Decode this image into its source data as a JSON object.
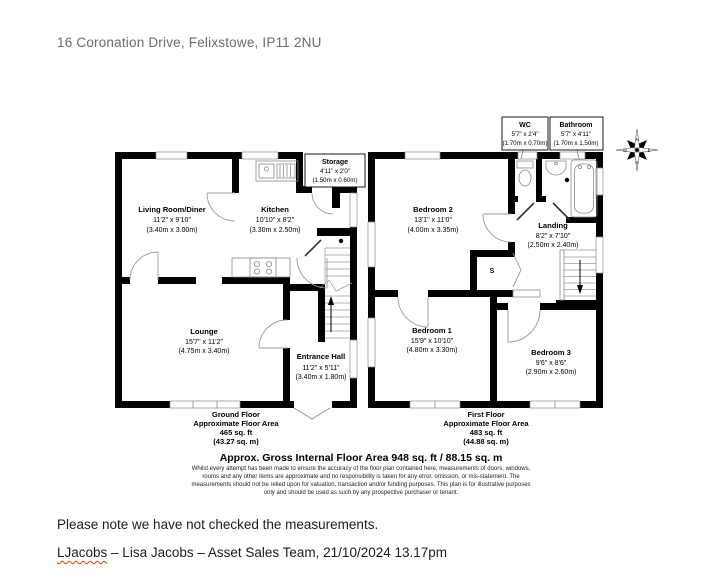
{
  "document": {
    "address": "16 Coronation Drive, Felixstowe, IP11 2NU",
    "note": "Please note we have not checked the measurements.",
    "signature_user": "LJacobs",
    "signature_rest": " – Lisa Jacobs – Asset Sales Team, 21/10/2024 13.17pm"
  },
  "floorplan": {
    "ground": {
      "rooms": [
        {
          "name": "Living Room/Diner",
          "imperial": "11'2\" x 9'10\"",
          "metric": "(3.40m x 3.00m)"
        },
        {
          "name": "Kitchen",
          "imperial": "10'10\" x 8'2\"",
          "metric": "(3.30m x 2.50m)"
        },
        {
          "name": "Storage",
          "imperial": "4'11\" x 2'0\"",
          "metric": "(1.50m x 0.60m)"
        },
        {
          "name": "Lounge",
          "imperial": "15'7\" x 11'2\"",
          "metric": "(4.75m x 3.40m)"
        },
        {
          "name": "Entrance Hall",
          "imperial": "11'2\" x 5'11\"",
          "metric": "(3.40m x 1.80m)"
        }
      ],
      "footer": {
        "floor": "Ground Floor",
        "label": "Approximate Floor Area",
        "sqft": "465 sq. ft",
        "sqm": "(43.27 sq. m)"
      }
    },
    "first": {
      "rooms": [
        {
          "name": "WC",
          "imperial": "5'7\" x 2'4\"",
          "metric": "(1.70m x 0.70m)"
        },
        {
          "name": "Bathroom",
          "imperial": "5'7\" x 4'11\"",
          "metric": "(1.70m x 1.50m)"
        },
        {
          "name": "Bedroom 2",
          "imperial": "13'1\" x 11'0\"",
          "metric": "(4.00m x 3.35m)"
        },
        {
          "name": "Landing",
          "imperial": "8'2\" x 7'10\"",
          "metric": "(2.50m x 2.40m)"
        },
        {
          "name": "Bedroom 1",
          "imperial": "15'9\" x 10'10\"",
          "metric": "(4.80m x 3.30m)"
        },
        {
          "name": "Bedroom 3",
          "imperial": "9'6\" x 8'6\"",
          "metric": "(2.90m x 2.60m)"
        }
      ],
      "cupboard_label": "S",
      "footer": {
        "floor": "First Floor",
        "label": "Approximate Floor Area",
        "sqft": "483 sq. ft",
        "sqm": "(44.88 sq. m)"
      }
    },
    "summary": {
      "title": "Approx. Gross Internal Floor Area 948 sq. ft / 88.15 sq. m",
      "disclaimer": [
        "Whilst every attempt has been made to ensure the accuracy of the floor plan contained here, measurements of doors, windows,",
        "rooms and any other items are approximate and no responsibility is taken for any error, omission, or mis-statement. The",
        "measurements should not be relied upon for valuation, transaction and/or funding purposes. This plan is for illustrative purposes",
        "only and should be used as such by any prospective purchaser or tenant."
      ]
    },
    "compass": {
      "n": "N",
      "s": "S",
      "e": "E",
      "w": "W"
    }
  },
  "colors": {
    "wall": "#000000",
    "thin_line": "#8a8a8a",
    "title_gray": "#6b6b6b",
    "body_text": "#1c1c1c",
    "spellcheck_red": "#d83b01",
    "page_bg": "#ffffff"
  }
}
